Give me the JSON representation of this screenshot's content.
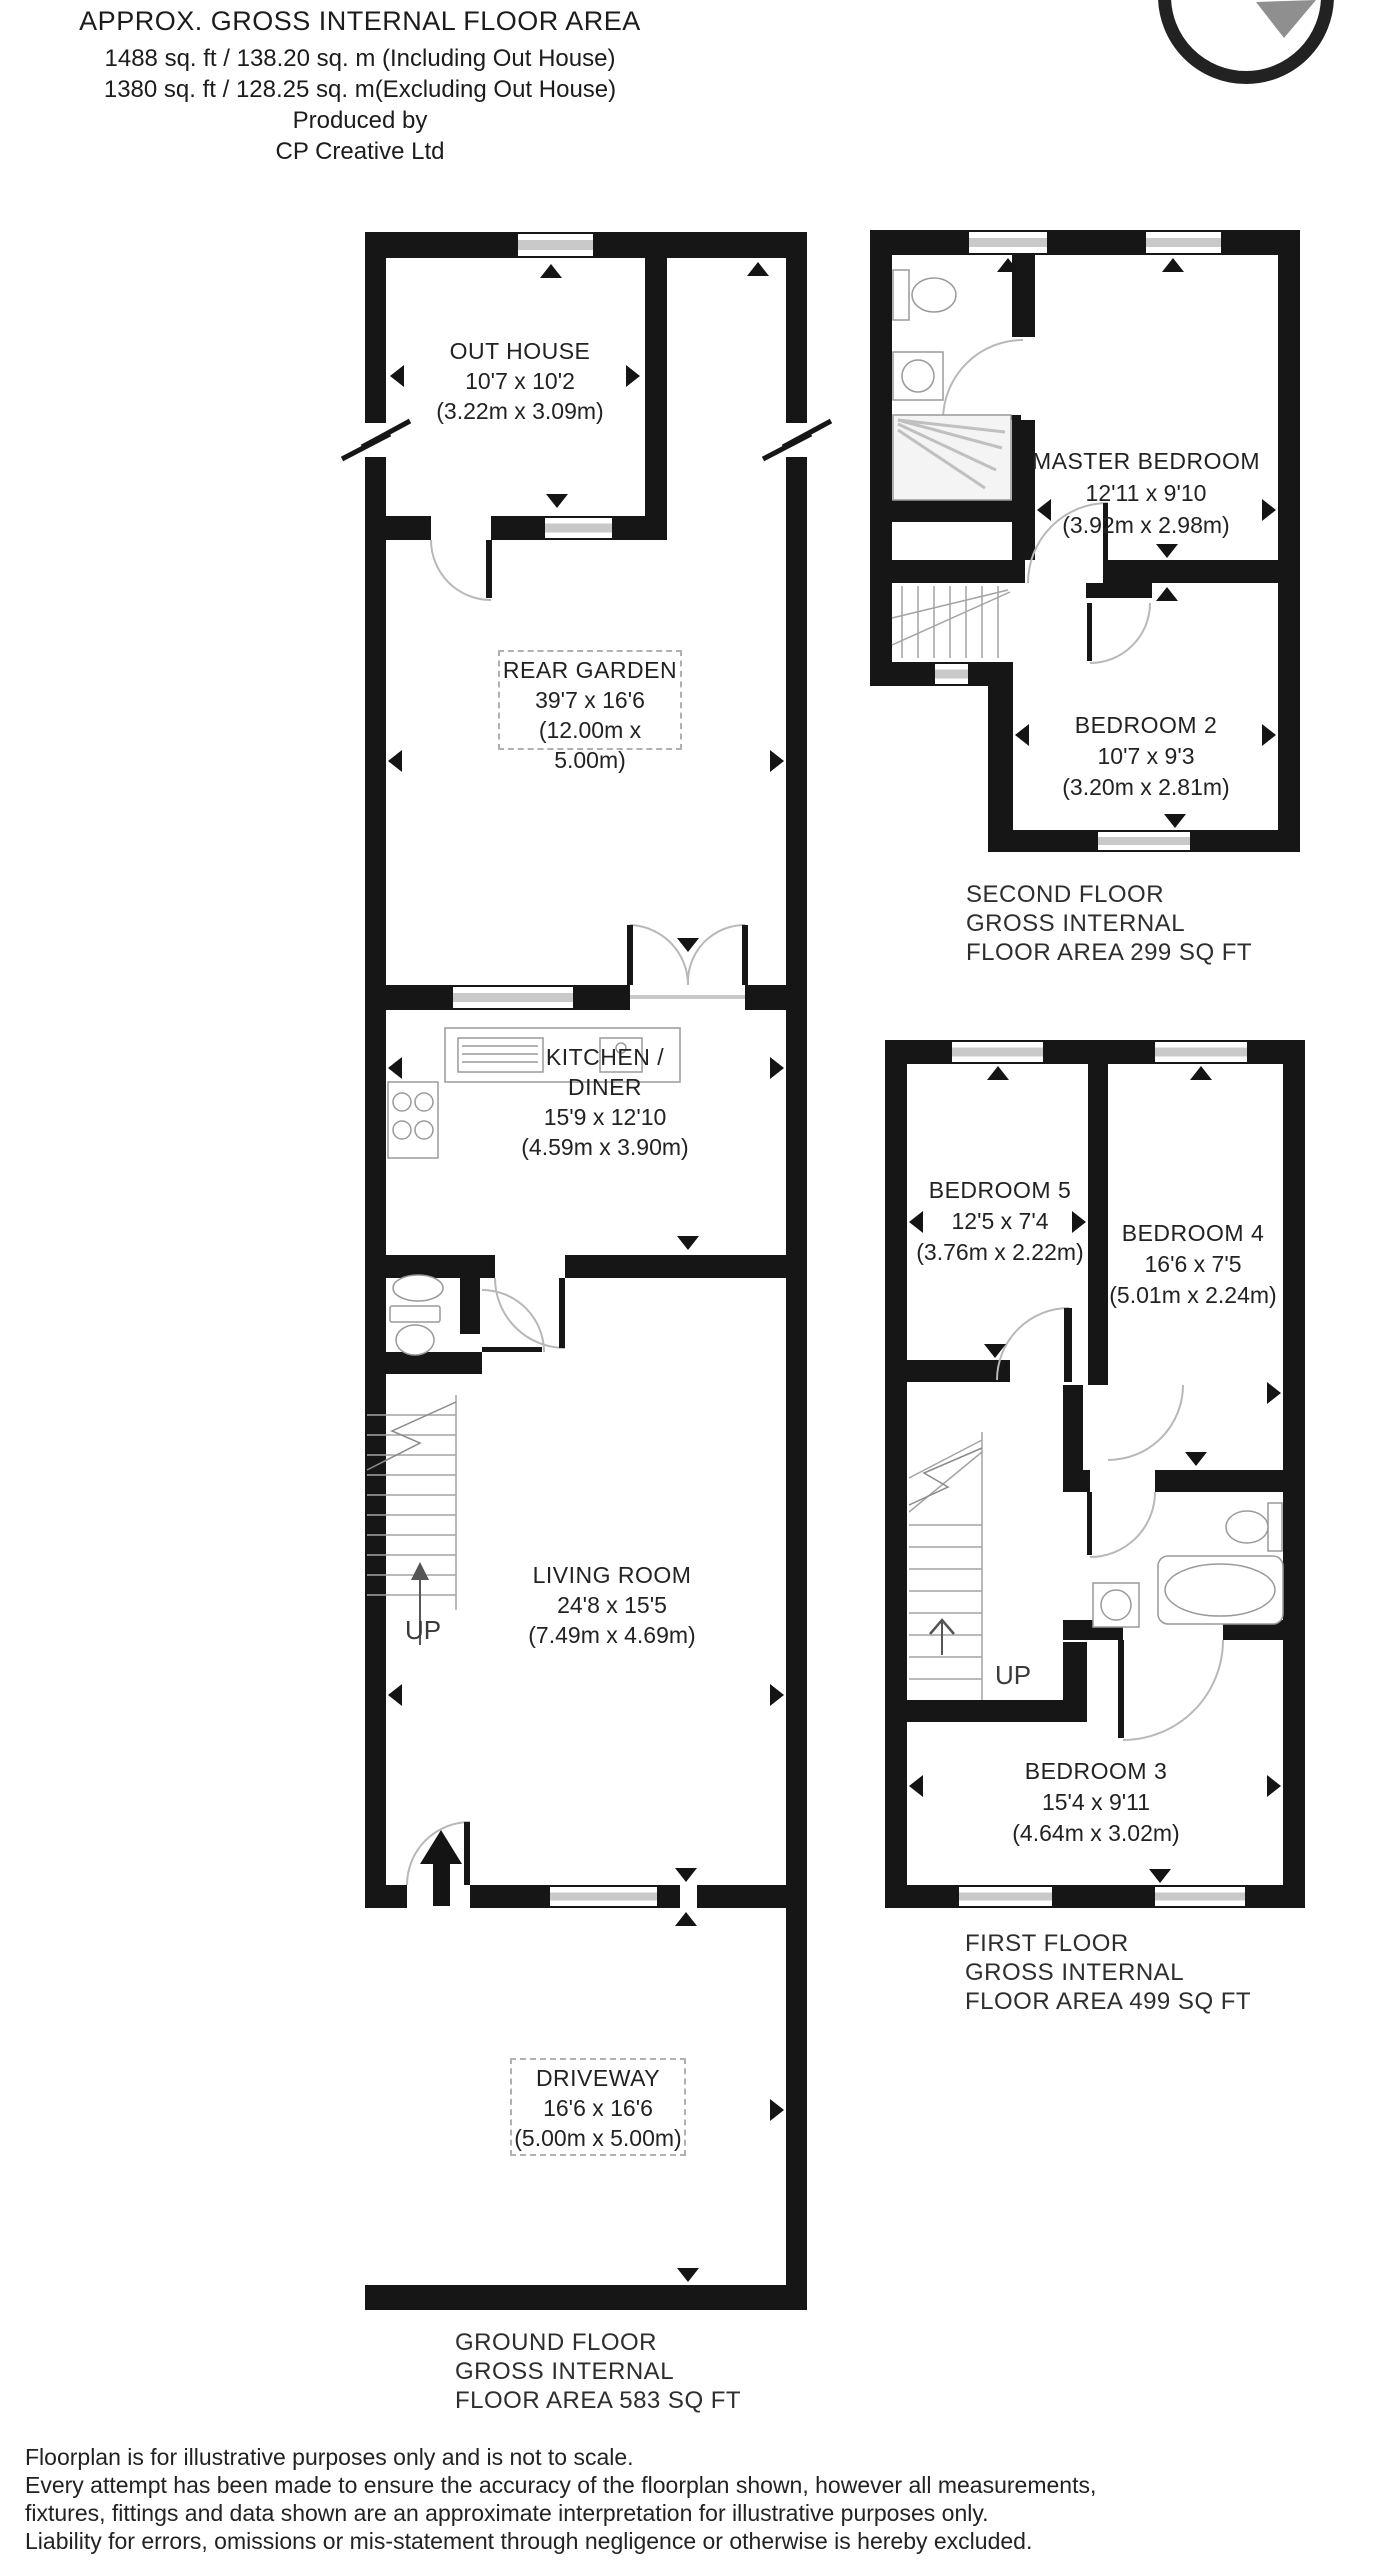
{
  "header": {
    "title": "APPROX. GROSS INTERNAL FLOOR AREA",
    "area_including": "1488 sq. ft / 138.20 sq. m (Including Out House)",
    "area_excluding": "1380 sq. ft / 128.25 sq. m(Excluding Out House)",
    "produced_by": "Produced by",
    "producer": "CP Creative Ltd"
  },
  "rooms": {
    "out_house": {
      "name": "OUT HOUSE",
      "imperial": "10'7 x 10'2",
      "metric": "(3.22m x 3.09m)"
    },
    "rear_garden": {
      "name": "REAR GARDEN",
      "imperial": "39'7 x 16'6",
      "metric": "(12.00m x 5.00m)"
    },
    "kitchen_diner": {
      "name_line1": "KITCHEN /",
      "name_line2": "DINER",
      "imperial": "15'9 x 12'10",
      "metric": "(4.59m x 3.90m)"
    },
    "living_room": {
      "name": "LIVING ROOM",
      "imperial": "24'8 x 15'5",
      "metric": "(7.49m x 4.69m)"
    },
    "driveway": {
      "name": "DRIVEWAY",
      "imperial": "16'6 x 16'6",
      "metric": "(5.00m x 5.00m)"
    },
    "master_bedroom": {
      "name": "MASTER BEDROOM",
      "imperial": "12'11 x 9'10",
      "metric": "(3.92m x 2.98m)"
    },
    "bedroom_2": {
      "name": "BEDROOM 2",
      "imperial": "10'7 x 9'3",
      "metric": "(3.20m x 2.81m)"
    },
    "bedroom_5": {
      "name": "BEDROOM 5",
      "imperial": "12'5 x 7'4",
      "metric": "(3.76m x 2.22m)"
    },
    "bedroom_4": {
      "name": "BEDROOM 4",
      "imperial": "16'6 x 7'5",
      "metric": "(5.01m x 2.24m)"
    },
    "bedroom_3": {
      "name": "BEDROOM 3",
      "imperial": "15'4 x 9'11",
      "metric": "(4.64m x 3.02m)"
    }
  },
  "floor_labels": {
    "ground": {
      "line1": "GROUND FLOOR",
      "line2": "GROSS INTERNAL",
      "line3": "FLOOR AREA 583 SQ FT"
    },
    "first": {
      "line1": "FIRST FLOOR",
      "line2": "GROSS INTERNAL",
      "line3": "FLOOR AREA 499 SQ FT"
    },
    "second": {
      "line1": "SECOND FLOOR",
      "line2": "GROSS INTERNAL",
      "line3": "FLOOR AREA 299 SQ FT"
    }
  },
  "stairs": {
    "ground_up": "UP",
    "first_up": "UP"
  },
  "disclaimer": {
    "line1": "Floorplan is for illustrative purposes only and is not to scale.",
    "line2": "Every attempt has been made to ensure the accuracy of the floorplan shown, however all measurements,",
    "line3": "fixtures, fittings and data shown are an approximate interpretation for illustrative purposes only.",
    "line4": "Liability for errors, omissions or mis-statement through negligence or otherwise is hereby excluded."
  }
}
